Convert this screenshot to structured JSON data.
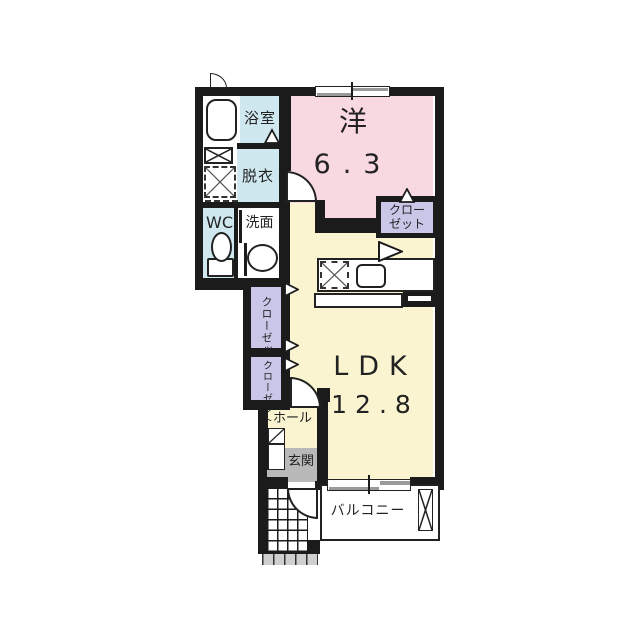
{
  "page": {
    "type": "apartment-floor-plan"
  },
  "rooms": {
    "bath": {
      "label": "浴室"
    },
    "dressing": {
      "label": "脱衣"
    },
    "wc": {
      "label": "WC"
    },
    "washroom": {
      "label": "洗面"
    },
    "western": {
      "label": "洋",
      "size": "6.3"
    },
    "closet_right": {
      "line1": "クロー",
      "line2": "ゼット"
    },
    "closet_left_upper": {
      "label": "クローゼット"
    },
    "closet_left_lower": {
      "label": "クローゼット"
    },
    "ldk": {
      "label": "LDK",
      "size": "12.8"
    },
    "hall": {
      "label": "ホール"
    },
    "entrance": {
      "label": "玄関"
    },
    "balcony": {
      "label": "バルコニー"
    }
  },
  "colors": {
    "wall": "#1b1b1b",
    "room-pink": "#f8d8e1",
    "room-blue": "#cfe8ef",
    "room-yellow": "#faf5d0",
    "room-purple": "#c9c6e8",
    "entrance-gray": "#b9b9b9",
    "step-gray": "#cfcfcf",
    "window-gray": "#9a9a9a",
    "text": "#222222"
  }
}
